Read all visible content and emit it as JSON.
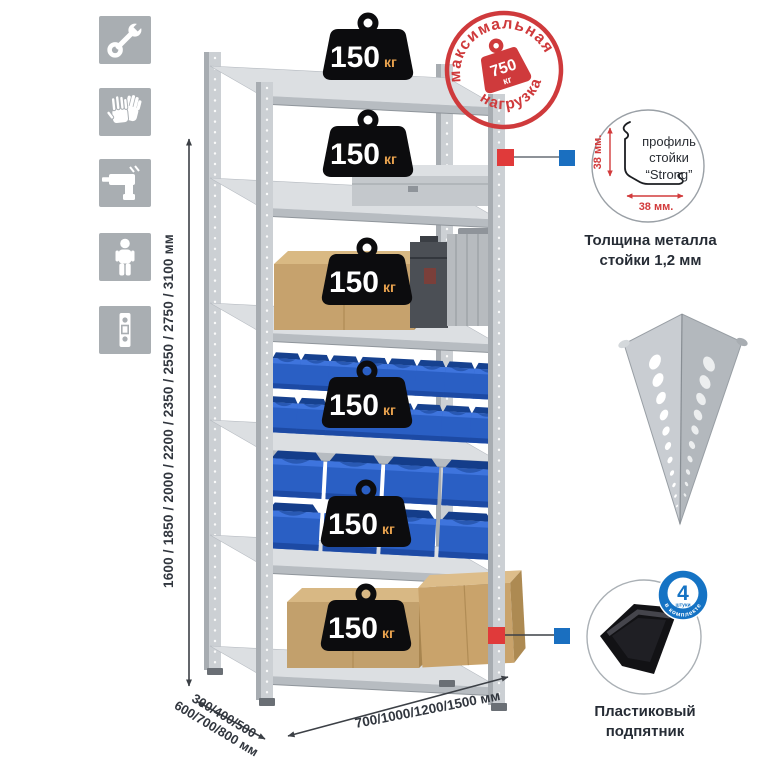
{
  "stamp": {
    "top_text": "максимальная",
    "bottom_text": "нагрузка",
    "value": "750",
    "unit": "кг"
  },
  "weight_badge": {
    "value": "150",
    "unit": "кг"
  },
  "dimensions": {
    "height": "1600 / 1850 / 2000 / 2200 / 2350 / 2550 / 2750 / 3100 мм",
    "depth_line1": "300/400/500",
    "depth_line2": "600/700/800 мм",
    "width": "700/1000/1200/1500 мм"
  },
  "profile_callout": {
    "label_line1": "профиль",
    "label_line2": "стойки",
    "label_line3": "“Strong”",
    "dim_vertical": "38 мм.",
    "dim_horizontal": "38 мм.",
    "caption_line1": "Толщина металла",
    "caption_line2": "стойки 1,2 мм"
  },
  "foot_callout": {
    "badge_value": "4",
    "badge_sub": "штуки",
    "badge_arc": "в комплекте",
    "caption_line1": "Пластиковый",
    "caption_line2": "подпятник"
  },
  "sidebar_icons": [
    {
      "name": "wrench"
    },
    {
      "name": "gloves"
    },
    {
      "name": "drill"
    },
    {
      "name": "person"
    },
    {
      "name": "perforated-post"
    }
  ],
  "colors": {
    "stamp_red": "#cf3a3c",
    "marker_red": "#e03a3a",
    "marker_blue": "#1a6fc0",
    "icon_gray": "#a9aeb2",
    "bin_blue": "#2a5fc4",
    "badge_black": "#0c0c0e",
    "badge_unit_orange": "#e8a24e",
    "text_dark": "#31363e"
  }
}
